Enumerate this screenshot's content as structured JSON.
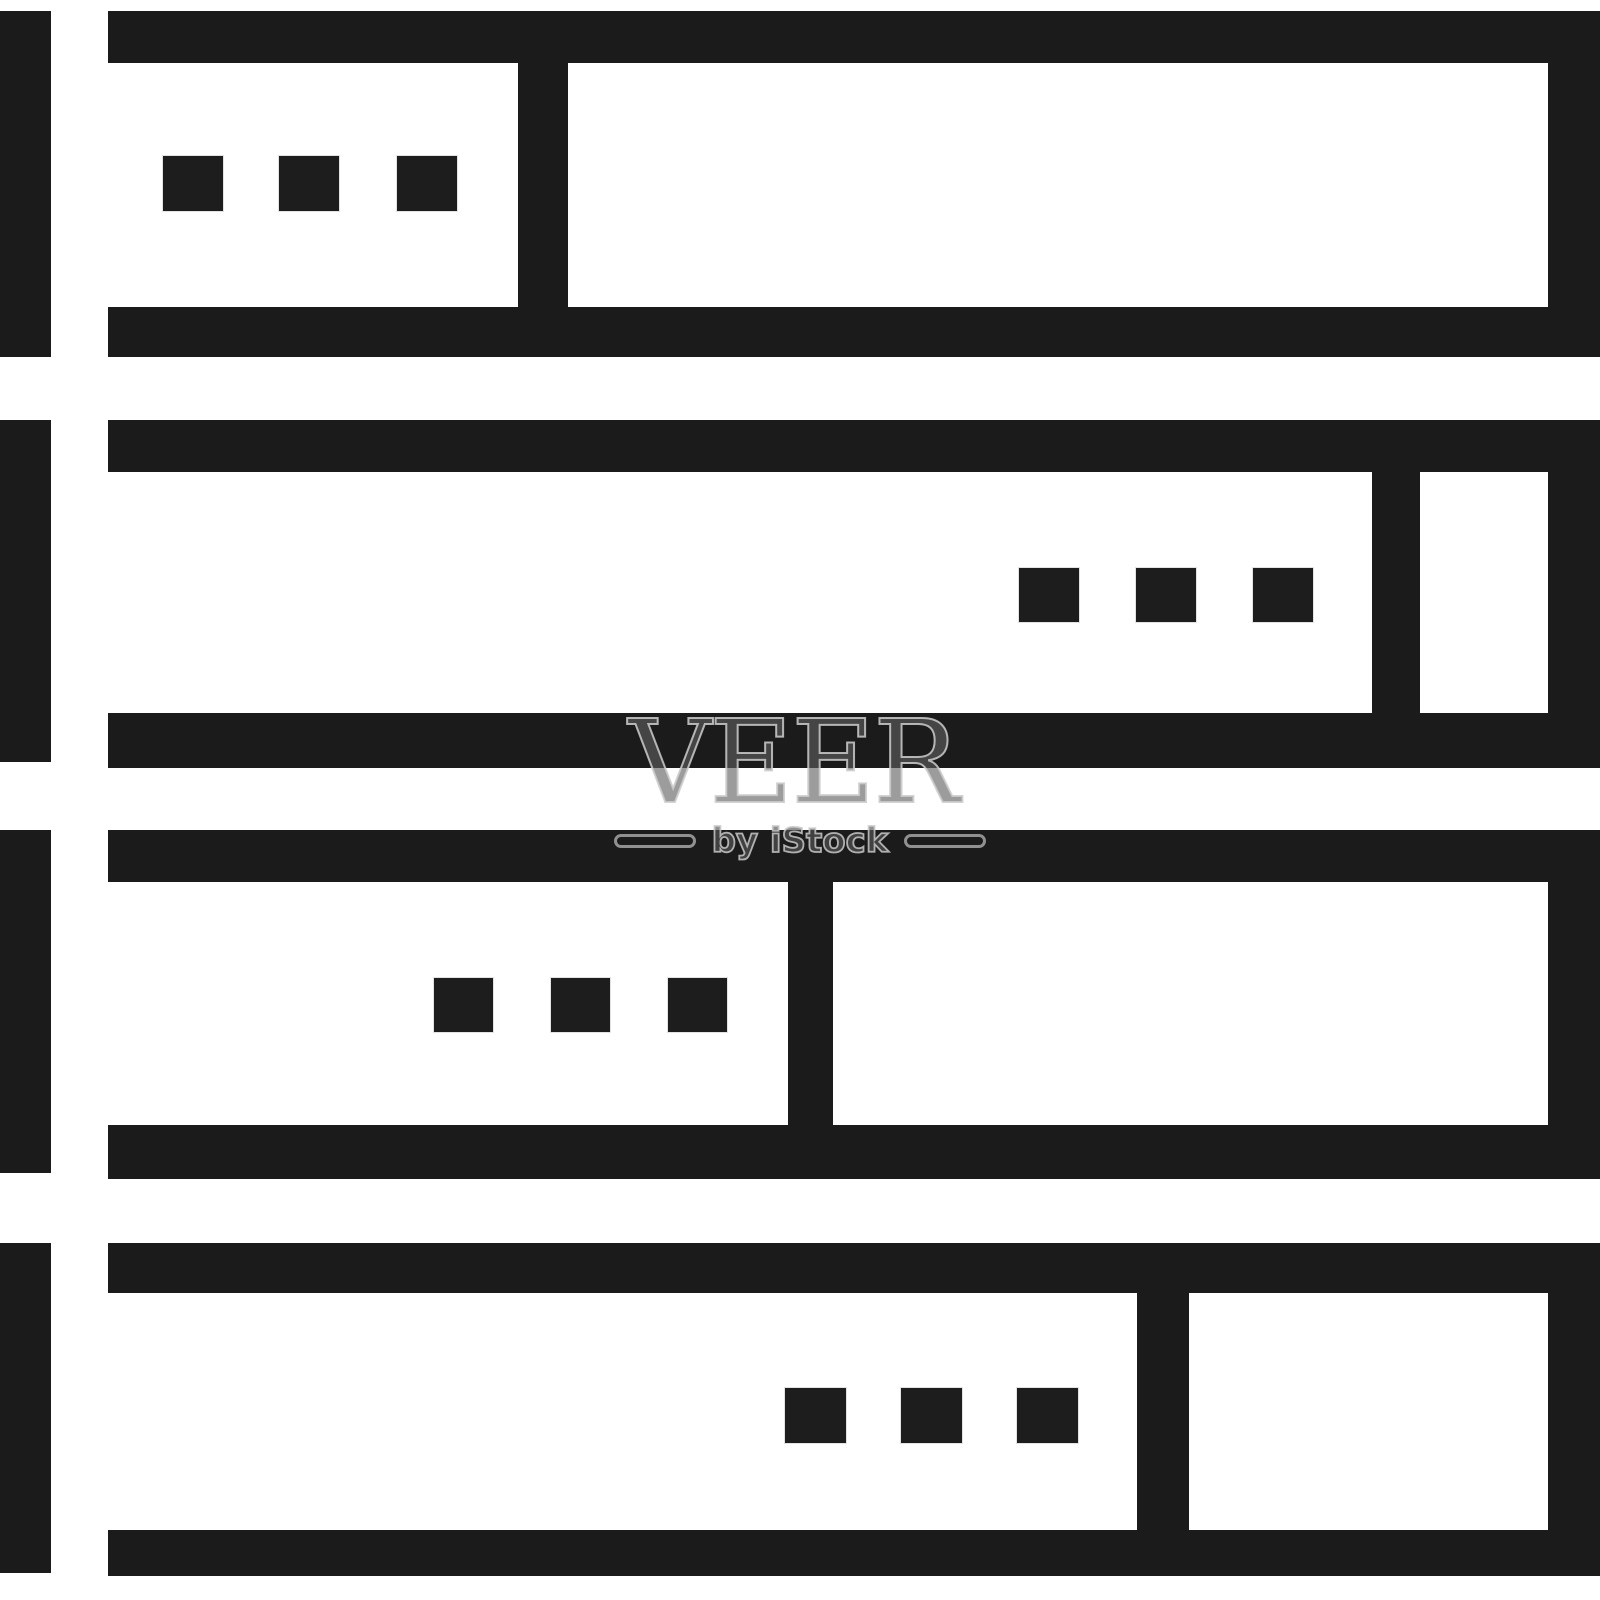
{
  "image_type": "stock-icon",
  "subject": "server-rack icon, four stacked server units, line style",
  "colors": {
    "ink": "#1b1b1b",
    "background": "#ffffff",
    "watermark_gray": "#9a9a9a"
  },
  "watermark": {
    "title": "VEER",
    "subtitle": "by iStock"
  },
  "icon_geometry": {
    "canvas_w": 1600,
    "canvas_h": 1600,
    "box_left": 108,
    "left_bar_w": 51,
    "right_wall": {
      "x": 1548,
      "w": 52
    },
    "rows": [
      {
        "name": "server-unit-1",
        "top_bar": {
          "y": 11,
          "h": 52
        },
        "bottom_bar": {
          "y": 307,
          "h": 50
        },
        "divider": {
          "x": 518,
          "w": 50
        },
        "left_bar": {
          "y": 11,
          "h": 346
        },
        "dots": {
          "y": 156,
          "h": 55,
          "w": 60,
          "xs": [
            163,
            279,
            397
          ]
        }
      },
      {
        "name": "server-unit-2",
        "top_bar": {
          "y": 420,
          "h": 52
        },
        "bottom_bar": {
          "y": 713,
          "h": 55
        },
        "divider": {
          "x": 1372,
          "w": 48
        },
        "left_bar": {
          "y": 420,
          "h": 342
        },
        "dots": {
          "y": 568,
          "h": 54,
          "w": 60,
          "xs": [
            1019,
            1136,
            1253
          ]
        }
      },
      {
        "name": "server-unit-3",
        "top_bar": {
          "y": 830,
          "h": 52
        },
        "bottom_bar": {
          "y": 1125,
          "h": 54
        },
        "divider": {
          "x": 788,
          "w": 45
        },
        "left_bar": {
          "y": 830,
          "h": 343
        },
        "dots": {
          "y": 978,
          "h": 54,
          "w": 59,
          "xs": [
            434,
            551,
            668
          ]
        }
      },
      {
        "name": "server-unit-4",
        "top_bar": {
          "y": 1243,
          "h": 50
        },
        "bottom_bar": {
          "y": 1530,
          "h": 46
        },
        "divider": {
          "x": 1137,
          "w": 52
        },
        "left_bar": {
          "y": 1243,
          "h": 330
        },
        "dots": {
          "y": 1388,
          "h": 55,
          "w": 61,
          "xs": [
            785,
            901,
            1017
          ]
        }
      }
    ]
  }
}
